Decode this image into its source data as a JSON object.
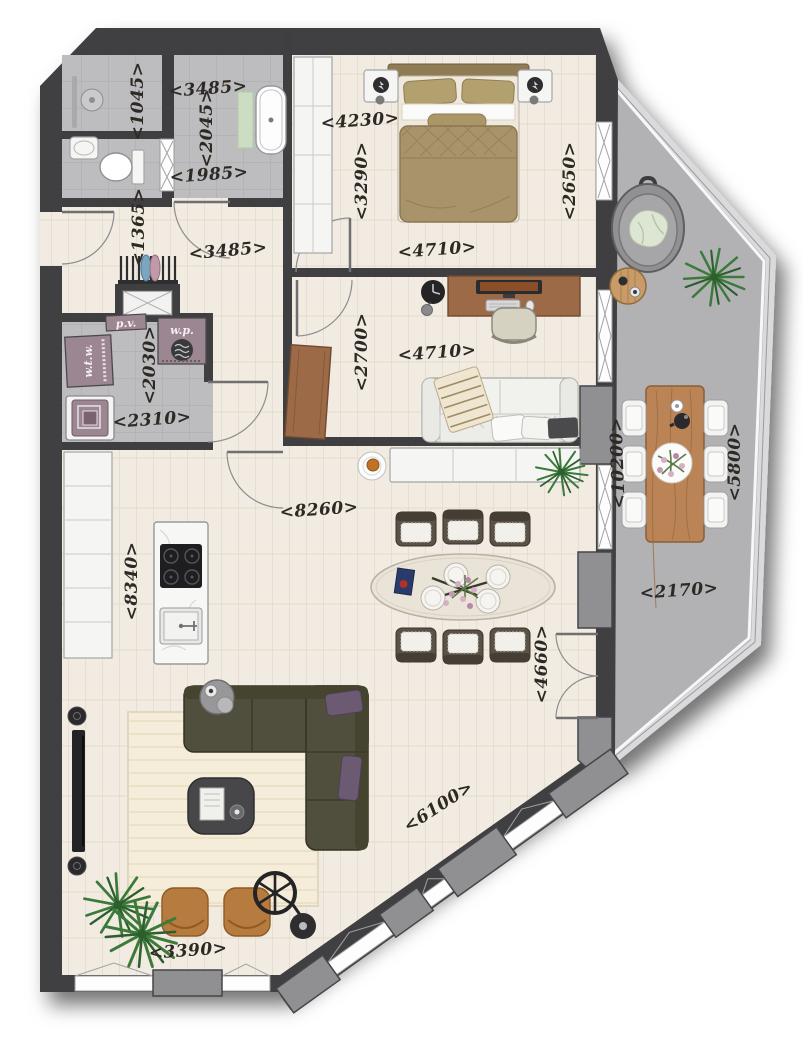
{
  "labels": {
    "dims": {
      "shower": "<1045>",
      "bath_width": "<3485>",
      "bath_depth": "<2045>",
      "bath_inner": "<1985>",
      "bed_top": "<4230>",
      "bed_left": "<3290>",
      "bed_right": "<2650>",
      "bed_bottom": "<4710>",
      "hall_entry": "<1365>",
      "hall_width": "<3485>",
      "office_depth": "<2700>",
      "office_width": "<4710>",
      "util_depth": "<2030>",
      "util_width": "<2310>",
      "kitchen_len": "<8340>",
      "living_width": "<8260>",
      "living_right": "<4660>",
      "living_bottom": "<3390>",
      "living_diag": "<6100>",
      "terrace_len": "<10200>",
      "terrace_right": "<5800>",
      "terrace_width": "<2170>"
    },
    "tech": {
      "wtw": "w.t.w.",
      "pv": "p.v.",
      "wp": "w.p."
    }
  },
  "colors": {
    "wall": "#3f3f42",
    "pier": "#909092",
    "tile": "#bdbdbf",
    "tile_line": "#a9a9ab",
    "wood": "#f1ebe1",
    "wood_line": "#e0d7c7",
    "terrace": "#b2b2b4",
    "railing": "#dadadc",
    "bed": "#a8936a",
    "bed_dark": "#8f7c55",
    "sofa": "#504f3d",
    "pillow": "#6c5a73",
    "pouf": "#b67b3f",
    "office_wood": "#9c6a47",
    "table_wood": "#bb8456",
    "plant": "#3c7a3b",
    "plant_dark": "#2c5e2e",
    "rug": "#f5edda",
    "mauve": "#9c8691"
  }
}
